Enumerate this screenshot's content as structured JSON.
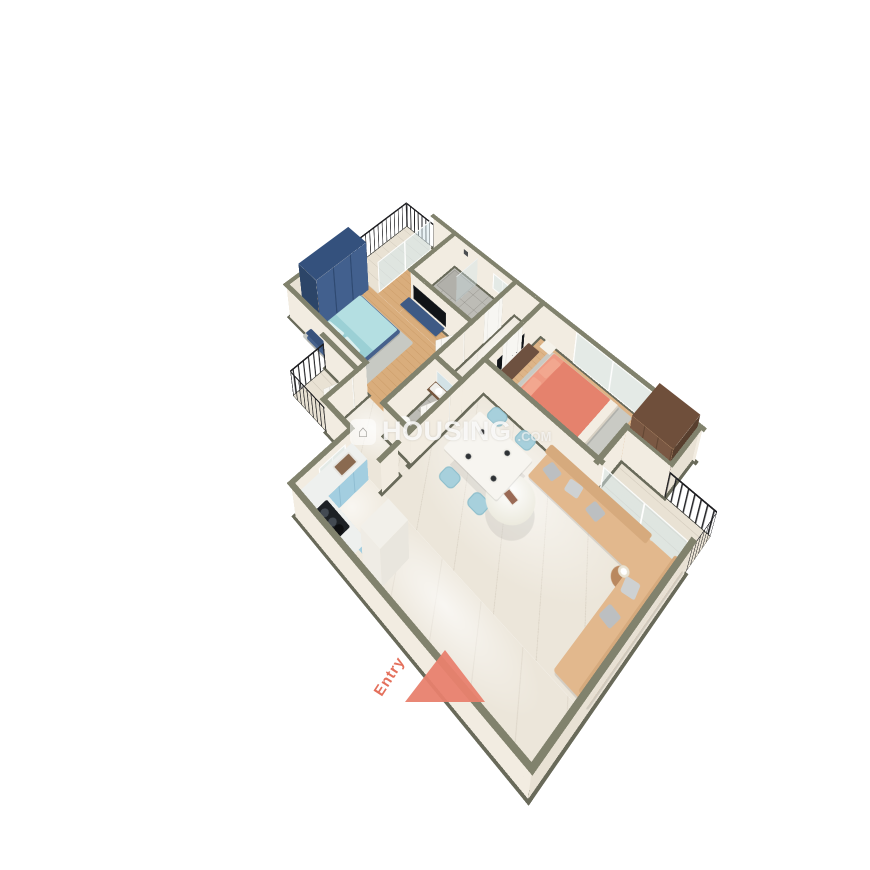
{
  "watermark": {
    "icon": "house-icon",
    "text": "HOUSING",
    "suffix": ".COM"
  },
  "entry": {
    "label": "Entry",
    "arrow_color": "#e8816e"
  },
  "palette": {
    "background": "#ffffff",
    "wall_top": "#81826d",
    "wall_face": "#f2ece1",
    "wood_floor": "#d9ad7c",
    "tile_floor": "#bdbcb6",
    "marble_floor": "#ece6da",
    "balcony_floor": "#e9e2d4",
    "railing": "#222225",
    "teal_bed": "#a6d7db",
    "coral_bed": "#e5826d",
    "navy_furniture": "#42608e",
    "brown_wardrobe": "#7a5843",
    "sofa_tan": "#e2b88d",
    "kitchen_cabinet": "#a3cee0",
    "dining_chair": "#a7d0dc"
  },
  "scene": {
    "type": "isometric-3d-floorplan",
    "unit": "2-bedroom apartment",
    "rooms": [
      {
        "name": "bedroom-2",
        "furniture": [
          "teal-double-bed",
          "navy-wardrobe",
          "tv-unit",
          "rug",
          "balcony-slider"
        ]
      },
      {
        "name": "bathroom-1",
        "furniture": [
          "shower",
          "glass-partition",
          "toilet",
          "washbasin",
          "mirror",
          "window"
        ]
      },
      {
        "name": "master-bedroom",
        "furniture": [
          "coral-double-bed",
          "brown-wardrobe",
          "tv-unit",
          "nightstands",
          "rug",
          "sliding-window"
        ]
      },
      {
        "name": "hallway",
        "furniture": [
          "doors"
        ]
      },
      {
        "name": "bathroom-2",
        "furniture": [
          "washbasin",
          "mirror",
          "toilet"
        ]
      },
      {
        "name": "living-dining",
        "furniture": [
          "l-shaped-sofa",
          "gray-pillows",
          "coffee-table",
          "side-table",
          "dining-table",
          "four-blue-chairs",
          "plates",
          "white-cabinet"
        ]
      },
      {
        "name": "kitchen",
        "furniture": [
          "l-counter",
          "sink",
          "hob",
          "window"
        ]
      },
      {
        "name": "balcony-1"
      },
      {
        "name": "balcony-2"
      },
      {
        "name": "balcony-3"
      },
      {
        "name": "entry",
        "furniture": [
          "entry-door",
          "entry-arrow"
        ]
      }
    ]
  }
}
